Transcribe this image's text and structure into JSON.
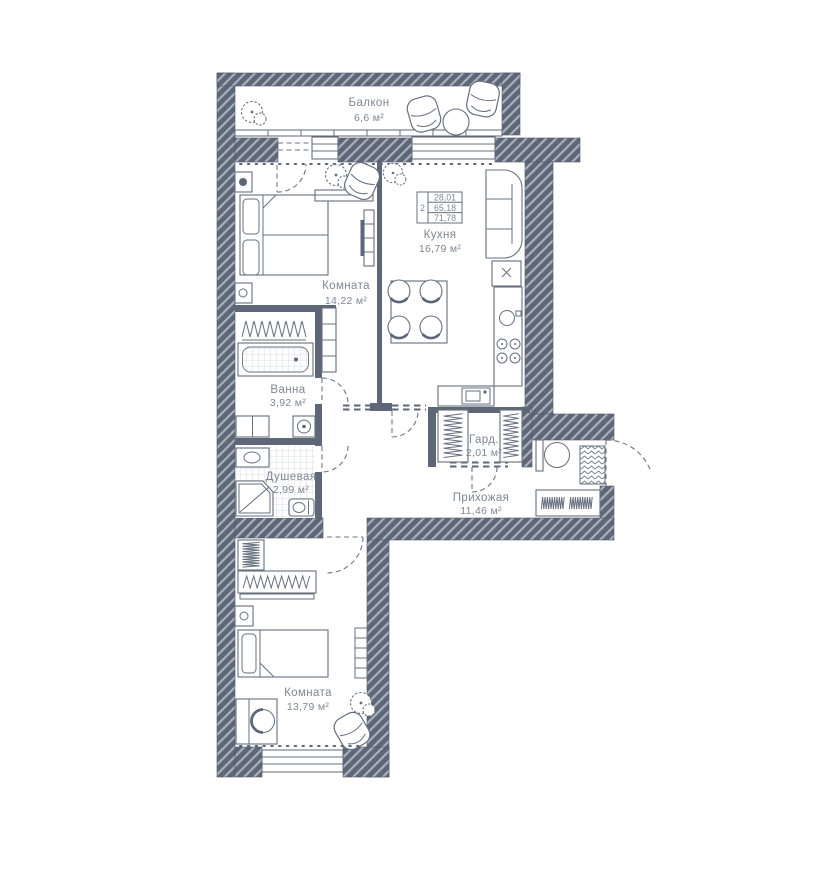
{
  "rooms": {
    "balcony": {
      "name": "Балкон",
      "area": "6,6 м²"
    },
    "bedroom": {
      "name": "Комната",
      "area": "14,22 м²"
    },
    "kitchen": {
      "name": "Кухня",
      "area": "16,79 м²"
    },
    "bath": {
      "name": "Ванна",
      "area": "3,92 м²"
    },
    "shower": {
      "name": "Душевая",
      "area": "2,99 м²"
    },
    "wardrobe": {
      "name": "Гард.",
      "area": "2,01 м²"
    },
    "hallway": {
      "name": "Прихожая",
      "area": "11,46 м²"
    },
    "bedroom2": {
      "name": "Комната",
      "area": "13,79 м²"
    }
  },
  "info_stamp": {
    "rooms_count": "2",
    "living_area": "28,01",
    "apartment_area": "65,18",
    "total_area": "71,78"
  },
  "colors": {
    "wall": "#5d6777",
    "wall_hatch_stripe": "#a9b0bb",
    "furniture_line": "#66707f",
    "label_text": "#7e8793",
    "dashed_line": "#6b7585"
  }
}
